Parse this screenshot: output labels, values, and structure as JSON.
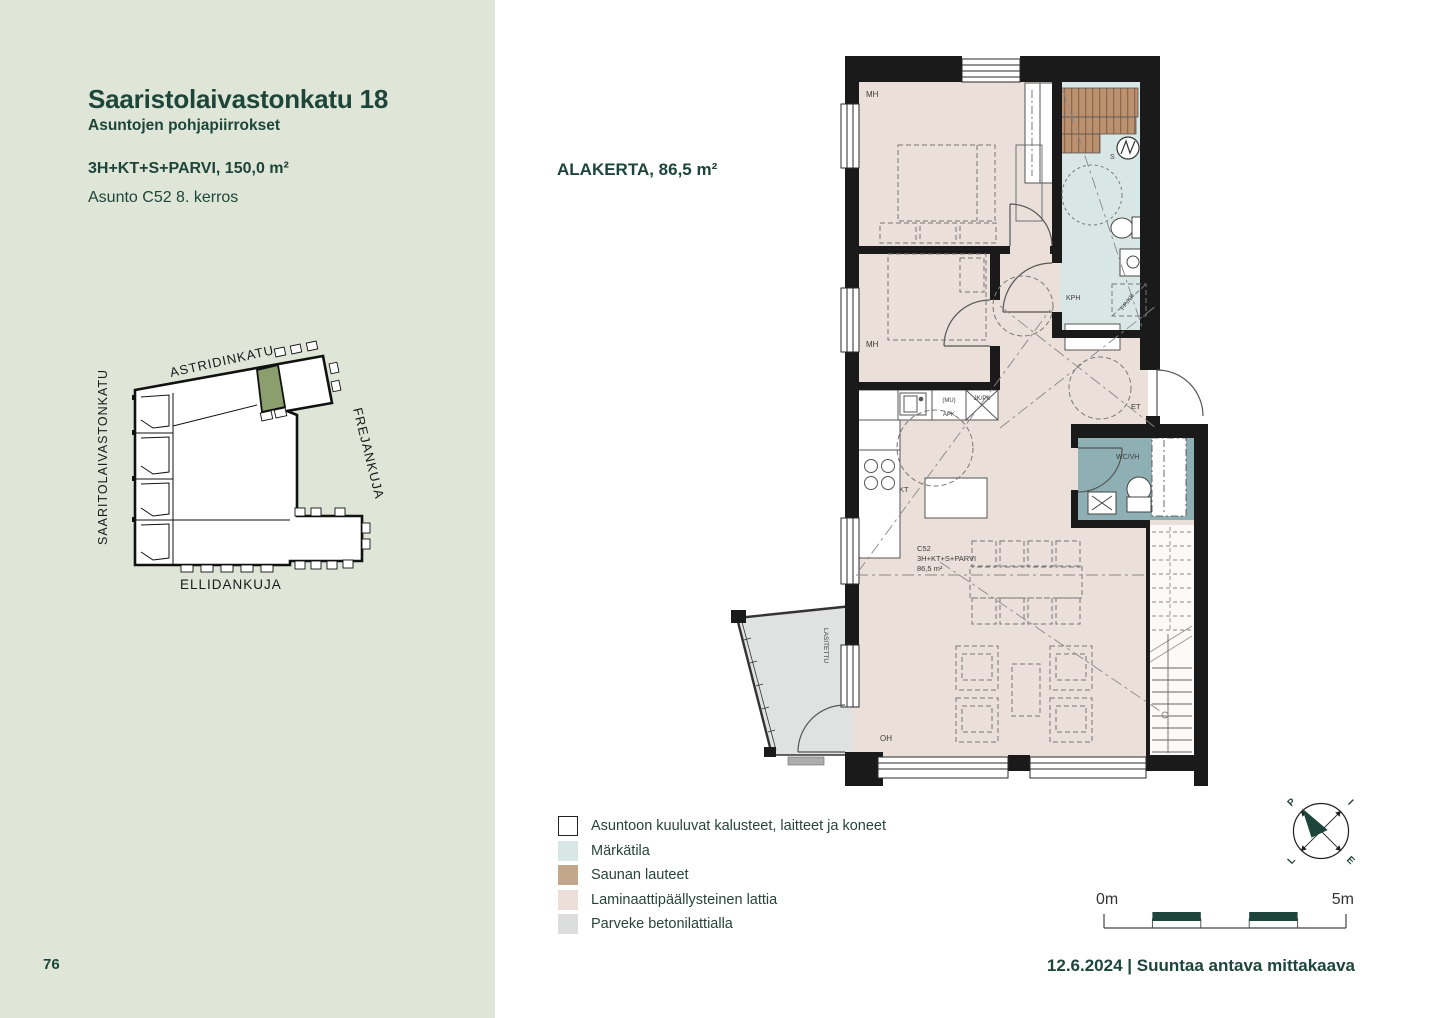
{
  "colors": {
    "sidebar_bg": "#dfe6d8",
    "brand_green": "#1d4539",
    "map_highlight": "#8a9f6d",
    "wall": "#1a1a1a",
    "floor_laminate": "#eadfd9",
    "wet_room": "#d8e7e5",
    "wc_room": "#8eb0b4",
    "sauna_wood": "#bb9170",
    "balcony_concrete": "#e0e1e1"
  },
  "sidebar": {
    "title": "Saaristolaivastonkatu 18",
    "subtitle": "Asuntojen pohjapiirrokset",
    "apartment_type": "3H+KT+S+PARVI, 150,0 m²",
    "apartment_unit": "Asunto C52  8. kerros",
    "page_number": "76",
    "site_map": {
      "street_top": "ASTRIDINKATU",
      "street_left": "SAARITOLAIVASTONKATU",
      "street_right": "FREJANKUJA",
      "street_bottom": "ELLIDANKUJA"
    }
  },
  "main": {
    "floor_title": "ALAKERTA, 86,5 m²",
    "floorplan": {
      "unit_id": "C52",
      "unit_type": "3H+KT+S+PARVI",
      "unit_area": "86,5 m²",
      "rooms": {
        "bedroom1": "MH",
        "bedroom2": "MH",
        "sauna": "S",
        "bathroom": "KPH",
        "kitchen": "KT",
        "entry": "ET",
        "wc": "WC/VH",
        "living": "OH",
        "balcony": "LASITETTU"
      },
      "appliances": {
        "mu": "(MU)",
        "apk": "APK",
        "jkpk": "JK/PK",
        "ppkr": "PP./KR"
      }
    },
    "legend": [
      {
        "label": "Asuntoon kuuluvat kalusteet, laitteet ja koneet",
        "swatch": "#ffffff"
      },
      {
        "label": "Märkätila",
        "swatch": "#d8e7e5"
      },
      {
        "label": "Saunan lauteet",
        "swatch": "#c4a68a"
      },
      {
        "label": "Laminaattipäällysteinen lattia",
        "swatch": "#ecdfd9"
      },
      {
        "label": "Parveke betonilattialla",
        "swatch": "#dcdedd"
      }
    ],
    "compass": {
      "north": "P",
      "east": "I",
      "west": "L",
      "south": "E"
    },
    "scale_bar": {
      "start": "0m",
      "end": "5m"
    },
    "footer": "12.6.2024 | Suuntaa antava mittakaava"
  }
}
